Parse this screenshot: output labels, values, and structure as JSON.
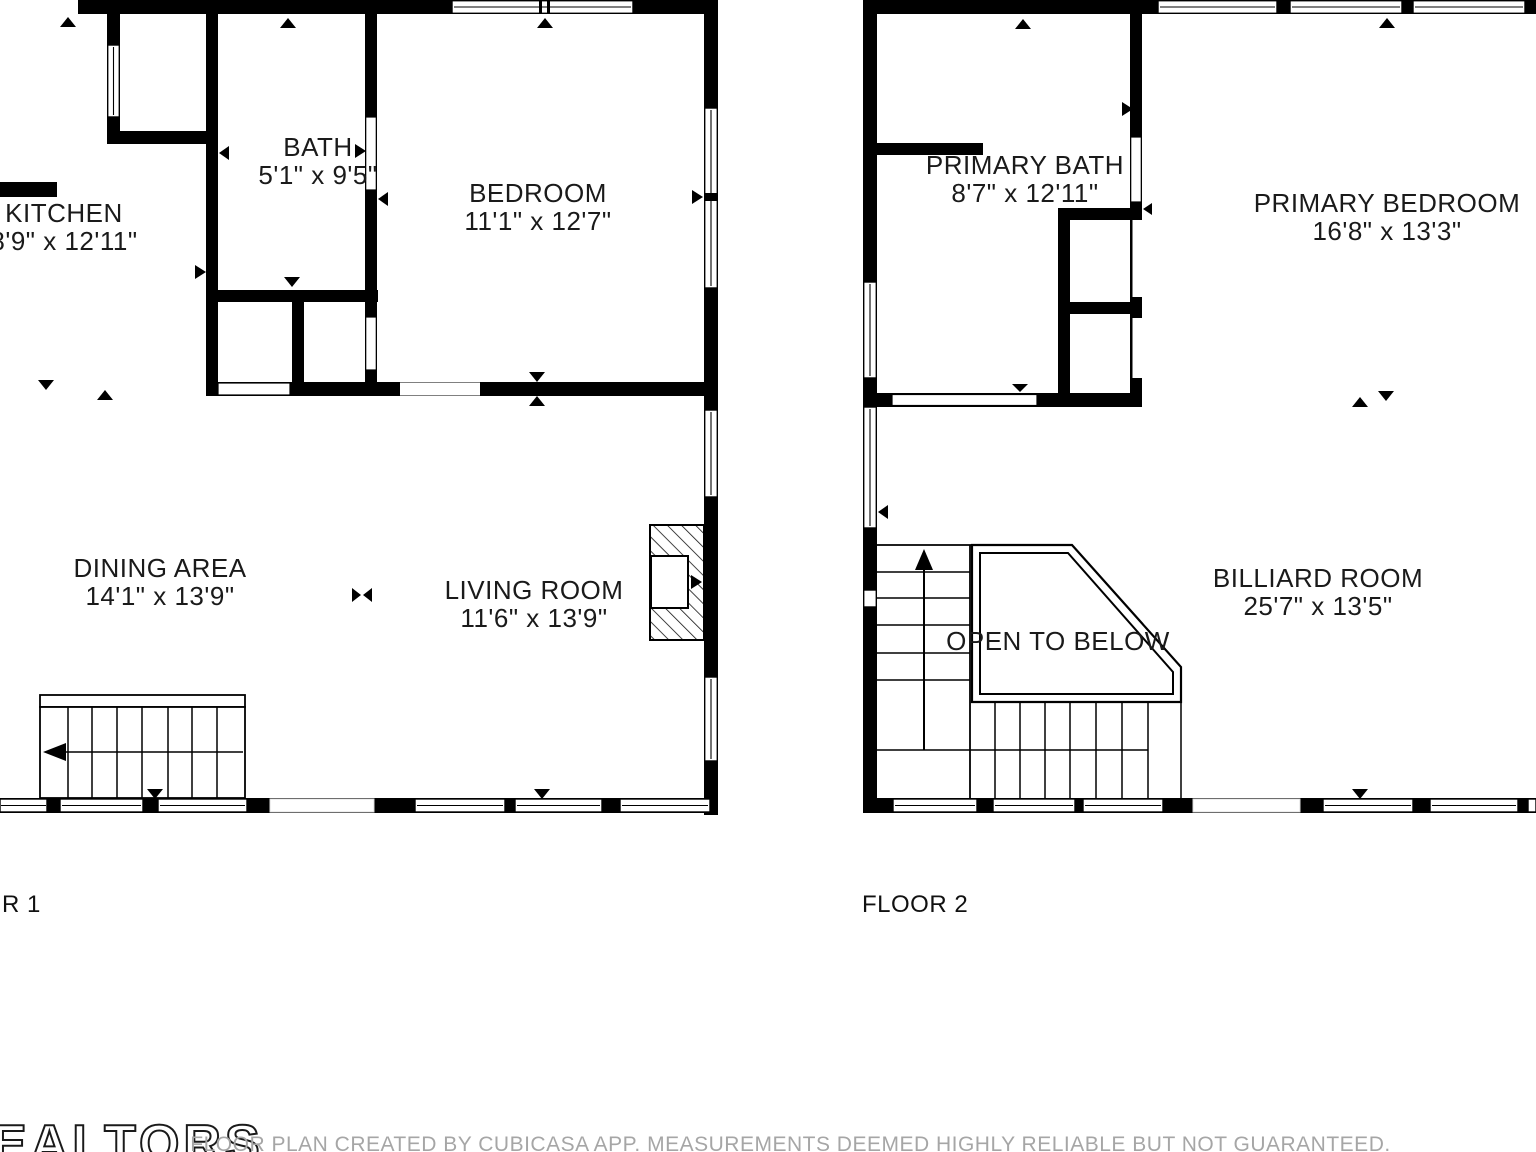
{
  "floor1": {
    "caption": "R 1",
    "rooms": {
      "kitchen": {
        "name": "KITCHEN",
        "dims": "8'9\" x 12'11\""
      },
      "bath": {
        "name": "BATH",
        "dims": "5'1\" x 9'5\""
      },
      "bedroom": {
        "name": "BEDROOM",
        "dims": "11'1\" x 12'7\""
      },
      "dining": {
        "name": "DINING AREA",
        "dims": "14'1\" x 13'9\""
      },
      "living": {
        "name": "LIVING ROOM",
        "dims": "11'6\" x 13'9\""
      }
    }
  },
  "floor2": {
    "caption": "FLOOR 2",
    "rooms": {
      "primary_bath": {
        "name": "PRIMARY BATH",
        "dims": "8'7\" x 12'11\""
      },
      "primary_bedroom": {
        "name": "PRIMARY BEDROOM",
        "dims": "16'8\" x 13'3\""
      },
      "billiard": {
        "name": "BILLIARD ROOM",
        "dims": "25'7\" x 13'5\""
      },
      "open_below": {
        "name": "OPEN TO BELOW"
      }
    }
  },
  "footer": {
    "logo_text": "EALTORS",
    "disclaimer": "FLOOR PLAN CREATED BY CUBICASA APP. MEASUREMENTS DEEMED HIGHLY RELIABLE BUT NOT GUARANTEED."
  },
  "colors": {
    "wall": "#000000",
    "label": "#1a1a1a",
    "disclaimer": "#a6a6a6"
  }
}
